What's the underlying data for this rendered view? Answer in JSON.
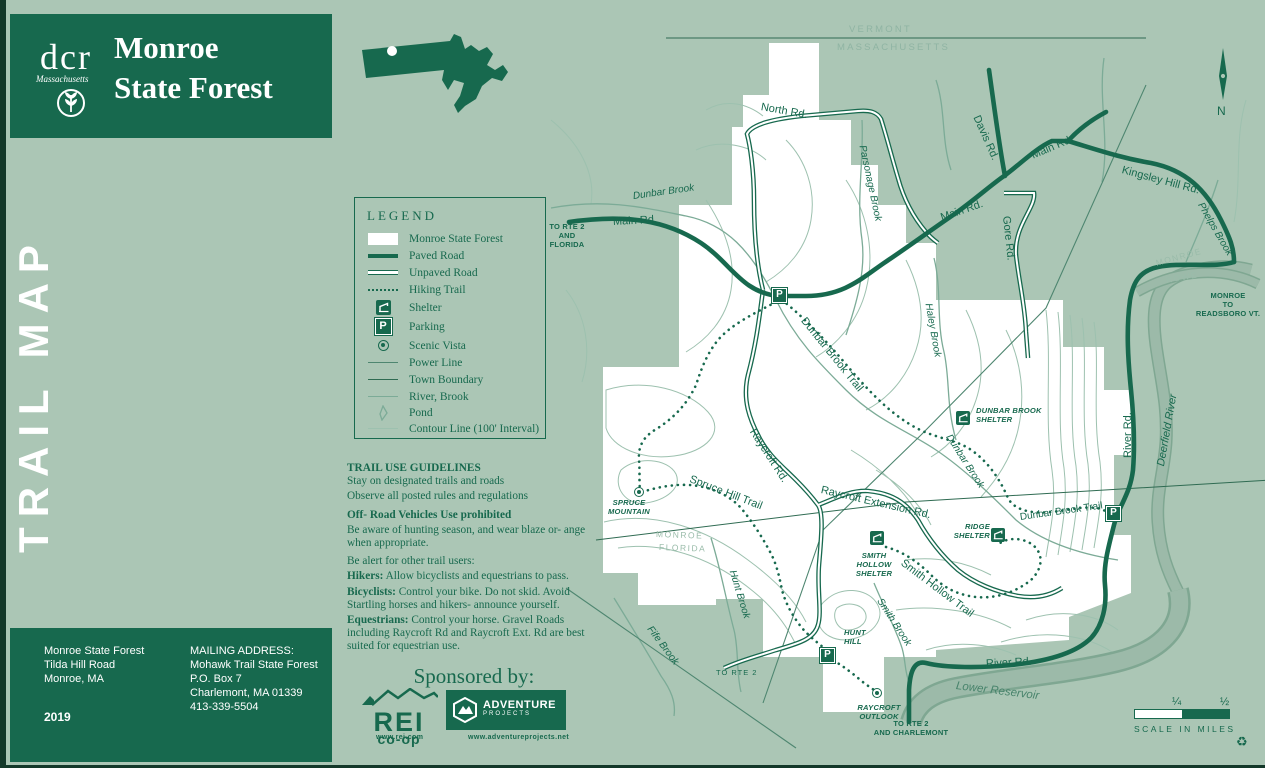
{
  "header": {
    "agency": "dcr",
    "agency_sub": "Massachusetts",
    "title_line1": "Monroe",
    "title_line2": "State Forest"
  },
  "sidebar": {
    "vertical_title": "TRAIL MAP"
  },
  "info_box": {
    "site_line1": "Monroe State Forest",
    "site_line2": "Tilda Hill Road",
    "site_line3": "Monroe, MA",
    "year": "2019",
    "mailing_label": "MAILING ADDRESS:",
    "mailing_line1": "Mohawk Trail State Forest",
    "mailing_line2": "P.O. Box 7",
    "mailing_line3": "Charlemont, MA 01339",
    "mailing_line4": "413-339-5504"
  },
  "legend": {
    "title": "LEGEND",
    "items": [
      {
        "icon": "forest-swatch",
        "label": "Monroe State Forest"
      },
      {
        "icon": "paved-road-line",
        "label": "Paved Road"
      },
      {
        "icon": "unpaved-road-line",
        "label": "Unpaved Road"
      },
      {
        "icon": "hiking-trail-dots",
        "label": "Hiking Trail"
      },
      {
        "icon": "shelter-icon",
        "label": "Shelter"
      },
      {
        "icon": "parking-icon",
        "label": "Parking"
      },
      {
        "icon": "scenic-vista-icon",
        "label": "Scenic Vista"
      },
      {
        "icon": "power-line",
        "label": "Power Line"
      },
      {
        "icon": "town-boundary-line",
        "label": "Town Boundary"
      },
      {
        "icon": "river-brook-line",
        "label": "River, Brook"
      },
      {
        "icon": "pond-shape",
        "label": "Pond"
      },
      {
        "icon": "contour-line",
        "label": "Contour Line (100' Interval)"
      }
    ],
    "parking_glyph": "P"
  },
  "guidelines": {
    "title": "TRAIL USE GUIDELINES",
    "intro1": "Stay on designated trails and roads",
    "intro2": "Observe all posted rules and regulations",
    "offroad": "Off- Road Vehicles Use prohibited",
    "hunting": "Be aware of hunting season, and wear blaze or- ange when appropriate.",
    "alert": "Be alert for other trail users:",
    "hikers_b": "Hikers:",
    "hikers_t": " Allow bicyclists and equestrians to pass.",
    "bikes_b": "Bicyclists:",
    "bikes_t": " Control your bike.  Do not skid. Avoid Startling horses and hikers- announce yourself.",
    "eq_b": "Equestrians:",
    "eq_t": " Control your horse. Gravel Roads including Raycroft Rd and Raycroft Ext. Rd are best suited for equestrian use."
  },
  "sponsors": {
    "heading": "Sponsored by:",
    "rei_name": "REI",
    "rei_sub": "co-op",
    "rei_url": "www.rei.com",
    "ap_line1": "ADVENTURE",
    "ap_line2": "PROJECTS",
    "ap_url": "www.adventureprojects.net"
  },
  "compass": {
    "north": "N"
  },
  "scale": {
    "quarter": "¼",
    "half": "½",
    "caption": "SCALE IN MILES",
    "recycle": "♻"
  },
  "map": {
    "labels": [
      {
        "t": "VERMONT"
      },
      {
        "t": "MASSACHUSETTS"
      },
      {
        "t": "North Rd."
      },
      {
        "t": "Parsonage Brook"
      },
      {
        "t": "Davis Rd."
      },
      {
        "t": "Main Rd."
      },
      {
        "t": "Main Rd."
      },
      {
        "t": "Kingsley Hill Rd."
      },
      {
        "t": "Phelps Brook"
      },
      {
        "t": "Gore Rd."
      },
      {
        "t": "Main Rd."
      },
      {
        "t": "Dunbar Brook"
      },
      {
        "t": "TO RTE 2"
      },
      {
        "t": "AND"
      },
      {
        "t": "FLORIDA"
      },
      {
        "t": "MONROE"
      },
      {
        "t": "ROWE"
      },
      {
        "t": "MONROE"
      },
      {
        "t": "TO"
      },
      {
        "t": "READSBORO VT."
      },
      {
        "t": "Haley Brook"
      },
      {
        "t": "Dunbar Brook Trail"
      },
      {
        "t": "DUNBAR BROOK SHELTER"
      },
      {
        "t": "River Rd."
      },
      {
        "t": "Deerfield River"
      },
      {
        "t": "Raycroft Rd."
      },
      {
        "t": "Dunbar Brook"
      },
      {
        "t": "Raycroft Extension Rd."
      },
      {
        "t": "Spruce Hill Trail"
      },
      {
        "t": "SPRUCE MOUNTAIN"
      },
      {
        "t": "MONROE"
      },
      {
        "t": "FLORIDA"
      },
      {
        "t": "Dunbar Brook Trail"
      },
      {
        "t": "RIDGE SHELTER"
      },
      {
        "t": "SMITH HOLLOW SHELTER"
      },
      {
        "t": "Smith Hollow Trail"
      },
      {
        "t": "Smith Brook"
      },
      {
        "t": "Hunt Brook"
      },
      {
        "t": "HUNT HILL"
      },
      {
        "t": "Fife Brook"
      },
      {
        "t": "TO RTE 2"
      },
      {
        "t": "RAYCROFT OUTLOOK"
      },
      {
        "t": "TO RTE 2"
      },
      {
        "t": "AND CHARLEMONT"
      },
      {
        "t": "River Rd."
      },
      {
        "t": "Lower Reservoir"
      }
    ],
    "parking_glyph": "P"
  }
}
